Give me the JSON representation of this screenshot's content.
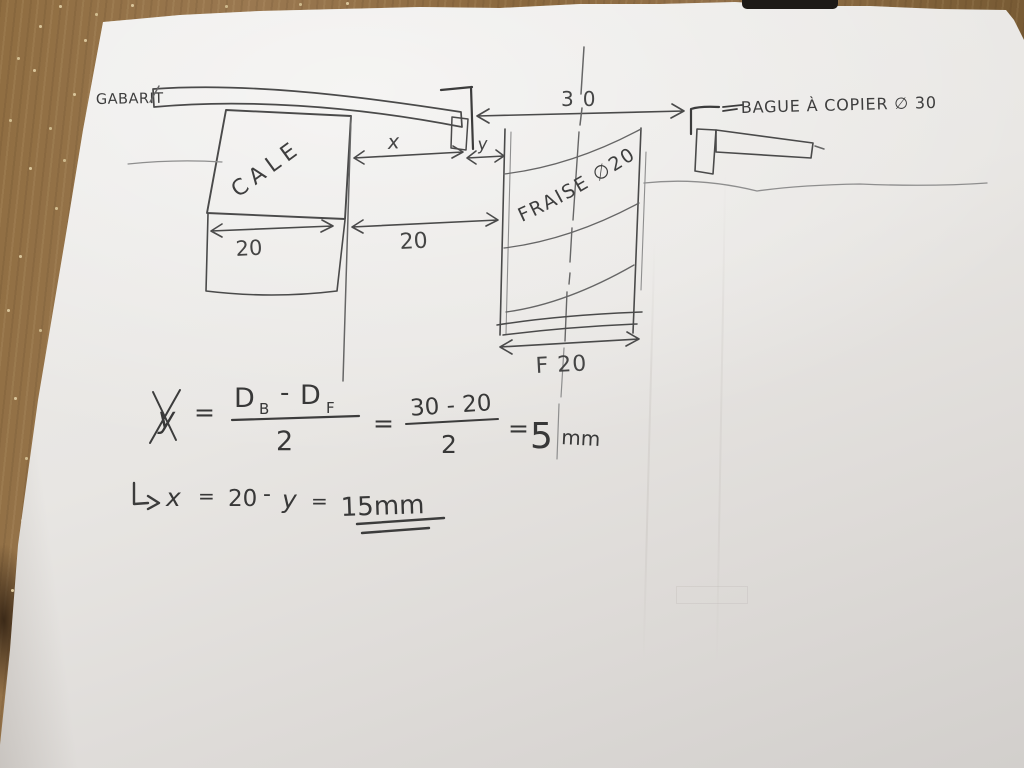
{
  "sketch": {
    "labels": {
      "gabarit": "GABARIT",
      "cale": "CALE",
      "fraise": "FRAISE ∅20",
      "bague": "BAGUE À COPIER  ∅ 30"
    },
    "dimensions": {
      "bague_inner": "30",
      "cale_width": "20",
      "offset": "20",
      "x": "x",
      "y": "y",
      "fraise_width": "F 20"
    },
    "formula1": {
      "lhs": "y",
      "eq": "=",
      "num_d1": "D",
      "num_d1_sub": "B",
      "minus": "-",
      "num_d2": "D",
      "num_d2_sub": "F",
      "den": "2",
      "eq2": "=",
      "num2": "30 - 20",
      "den2": "2",
      "eq3": "=",
      "result": "5",
      "unit": "mm"
    },
    "formula2": {
      "lhs": "x",
      "eq": "=",
      "a": "20",
      "minus": "-",
      "b": "y",
      "eq2": "=",
      "result": "15mm"
    },
    "colors": {
      "paper": "#e8e5e2",
      "wood": "#8d6b40",
      "pencil": "#4a4a4a"
    }
  }
}
